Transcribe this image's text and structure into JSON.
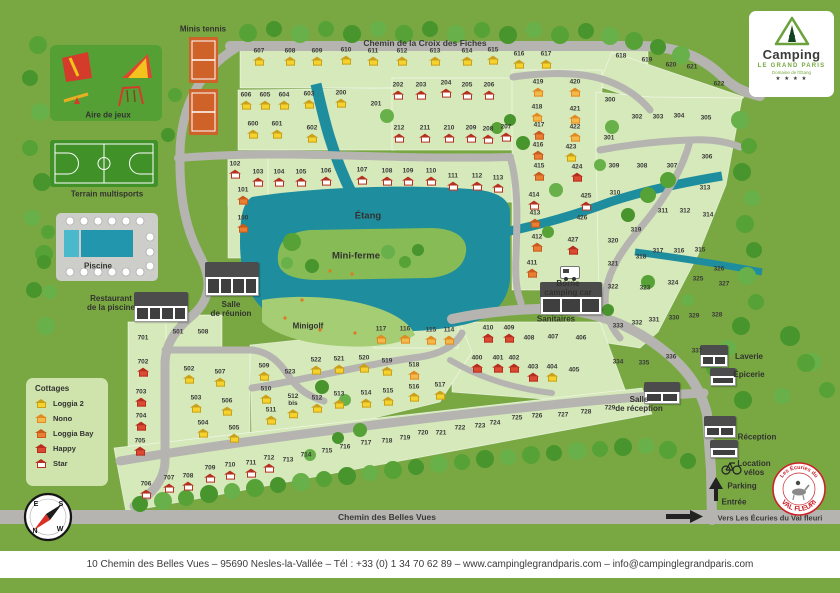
{
  "colors": {
    "background": "#79a843",
    "plot_area": "#d6e9bb",
    "road": "#b5b4b0",
    "pond": "#1e8d9e",
    "island": "#86bb55",
    "minigolf": "#a5cd74",
    "tree": [
      "#56a236",
      "#47952c",
      "#68b14a"
    ],
    "cottages": {
      "l2": {
        "roof": "#caa019",
        "body": "#f5d32c"
      },
      "no": {
        "roof": "#e08a21",
        "body": "#f4b94a"
      },
      "lb": {
        "roof": "#c85a1c",
        "body": "#ea7f33"
      },
      "ha": {
        "roof": "#b72c1c",
        "body": "#dd4a33"
      },
      "st": {
        "roof": "#b5301f",
        "body": "#ffffff"
      }
    }
  },
  "logo": {
    "brand": "Camping",
    "name": "LE GRAND PARIS",
    "tagline": "Domaine de l'Étang",
    "stars": "★ ★ ★ ★"
  },
  "valfleuri": {
    "top": "Les Écuries du",
    "bottom": "VAL FLEURI"
  },
  "footer": {
    "text": "10 Chemin des Belles Vues – 95690 Nesles-la-Vallée – Tél : +33 (0) 1 34 70 62 89 – www.campinglegrandparis.com –  info@campinglegrandparis.com"
  },
  "roads": {
    "top": "Chemin de la Croix des Fiches",
    "bottom": "Chemin des Belles Vues",
    "exit": "Vers Les Écuries du Val fleuri"
  },
  "legend": {
    "title": "Cottages",
    "items": [
      {
        "label": "Loggia 2",
        "type": "l2"
      },
      {
        "label": "Nono",
        "type": "no"
      },
      {
        "label": "Loggia Bay",
        "type": "lb"
      },
      {
        "label": "Happy",
        "type": "ha"
      },
      {
        "label": "Star",
        "type": "st"
      }
    ]
  },
  "compass": {
    "points": [
      "E",
      "S",
      "N",
      "W"
    ]
  },
  "facilities": [
    {
      "id": "minis-tennis",
      "label": "Minis tennis",
      "x": 203,
      "y": 29,
      "big": false
    },
    {
      "id": "aire-de-jeux",
      "label": "Aire de jeux",
      "x": 108,
      "y": 115,
      "big": false
    },
    {
      "id": "terrain-multisports",
      "label": "Terrain multisports",
      "x": 107,
      "y": 194,
      "big": false
    },
    {
      "id": "piscine",
      "label": "Piscine",
      "x": 98,
      "y": 266,
      "big": false
    },
    {
      "id": "restaurant-piscine",
      "label": "Restaurant\nde la piscine",
      "x": 111,
      "y": 303,
      "big": false
    },
    {
      "id": "salle-de-reunion",
      "label": "Salle\nde réunion",
      "x": 231,
      "y": 309,
      "big": false
    },
    {
      "id": "etang",
      "label": "Étang",
      "x": 368,
      "y": 217,
      "big": true
    },
    {
      "id": "mini-ferme",
      "label": "Mini-ferme",
      "x": 356,
      "y": 257,
      "big": true
    },
    {
      "id": "minigolf",
      "label": "Minigolf",
      "x": 308,
      "y": 326,
      "big": false
    },
    {
      "id": "borne-camping-car",
      "label": "Borne\ncamping car",
      "x": 568,
      "y": 288,
      "big": false
    },
    {
      "id": "sanitaires",
      "label": "Sanitaires",
      "x": 556,
      "y": 319,
      "big": false
    },
    {
      "id": "laverie-epicerie",
      "label": "Laverie\n\nÉpicerie",
      "x": 749,
      "y": 366,
      "big": false
    },
    {
      "id": "salle-de-reception",
      "label": "Salle\nde réception",
      "x": 639,
      "y": 404,
      "big": false
    },
    {
      "id": "reception",
      "label": "Réception",
      "x": 757,
      "y": 437,
      "big": false
    },
    {
      "id": "location-velos",
      "label": "Location\nvélos",
      "x": 754,
      "y": 468,
      "big": false
    },
    {
      "id": "parking",
      "label": "Parking",
      "x": 742,
      "y": 486,
      "big": false
    },
    {
      "id": "entree",
      "label": "Entrée",
      "x": 734,
      "y": 502,
      "big": false
    }
  ],
  "plots": [
    [
      "607",
      259,
      57,
      "l2"
    ],
    [
      "608",
      290,
      57,
      "l2"
    ],
    [
      "609",
      317,
      57,
      "l2"
    ],
    [
      "610",
      346,
      56,
      "l2"
    ],
    [
      "611",
      373,
      57,
      "l2"
    ],
    [
      "612",
      402,
      57,
      "l2"
    ],
    [
      "613",
      435,
      57,
      "l2"
    ],
    [
      "614",
      467,
      57,
      "l2"
    ],
    [
      "615",
      493,
      56,
      "l2"
    ],
    [
      "616",
      519,
      60,
      "l2"
    ],
    [
      "617",
      546,
      60,
      "l2"
    ],
    [
      "618",
      621,
      57,
      null
    ],
    [
      "619",
      647,
      61,
      null
    ],
    [
      "620",
      671,
      66,
      null
    ],
    [
      "621",
      692,
      68,
      null
    ],
    [
      "622",
      719,
      85,
      null
    ],
    [
      "606",
      246,
      101,
      "l2"
    ],
    [
      "605",
      265,
      101,
      "l2"
    ],
    [
      "604",
      284,
      101,
      "l2"
    ],
    [
      "603",
      309,
      100,
      "l2"
    ],
    [
      "600",
      253,
      130,
      "l2"
    ],
    [
      "601",
      277,
      130,
      "l2"
    ],
    [
      "602",
      312,
      134,
      "l2"
    ],
    [
      "200",
      341,
      99,
      "l2"
    ],
    [
      "201",
      376,
      105,
      null
    ],
    [
      "202",
      398,
      91,
      "st"
    ],
    [
      "203",
      421,
      91,
      "st"
    ],
    [
      "204",
      446,
      89,
      "st"
    ],
    [
      "205",
      467,
      91,
      "st"
    ],
    [
      "206",
      489,
      91,
      "st"
    ],
    [
      "212",
      399,
      134,
      "st"
    ],
    [
      "211",
      425,
      134,
      "st"
    ],
    [
      "210",
      449,
      134,
      "st"
    ],
    [
      "209",
      471,
      134,
      "st"
    ],
    [
      "208",
      488,
      135,
      "st"
    ],
    [
      "207",
      506,
      133,
      "st"
    ],
    [
      "102",
      235,
      170,
      "st"
    ],
    [
      "103",
      258,
      178,
      "st"
    ],
    [
      "104",
      279,
      178,
      "st"
    ],
    [
      "105",
      301,
      178,
      "st"
    ],
    [
      "106",
      326,
      177,
      "st"
    ],
    [
      "107",
      362,
      176,
      "st"
    ],
    [
      "108",
      387,
      177,
      "st"
    ],
    [
      "109",
      408,
      177,
      "st"
    ],
    [
      "110",
      431,
      177,
      "st"
    ],
    [
      "111",
      453,
      182,
      "st"
    ],
    [
      "112",
      477,
      182,
      "st"
    ],
    [
      "113",
      498,
      184,
      "st"
    ],
    [
      "101",
      243,
      196,
      "lb"
    ],
    [
      "100",
      243,
      224,
      "lb"
    ],
    [
      "419",
      538,
      88,
      "no"
    ],
    [
      "420",
      575,
      88,
      "no"
    ],
    [
      "418",
      537,
      113,
      "no"
    ],
    [
      "421",
      575,
      115,
      "no"
    ],
    [
      "417",
      539,
      131,
      "lb"
    ],
    [
      "422",
      575,
      133,
      "no"
    ],
    [
      "416",
      538,
      151,
      "lb"
    ],
    [
      "423",
      571,
      153,
      "l2"
    ],
    [
      "415",
      539,
      172,
      "lb"
    ],
    [
      "424",
      577,
      173,
      "ha"
    ],
    [
      "414",
      534,
      201,
      "st"
    ],
    [
      "425",
      586,
      202,
      "st"
    ],
    [
      "413",
      535,
      219,
      "lb"
    ],
    [
      "426",
      582,
      219,
      null
    ],
    [
      "412",
      537,
      243,
      "lb"
    ],
    [
      "427",
      573,
      246,
      "ha"
    ],
    [
      "411",
      532,
      269,
      "lb"
    ],
    [
      "300",
      610,
      101,
      null
    ],
    [
      "301",
      609,
      139,
      null
    ],
    [
      "302",
      637,
      118,
      null
    ],
    [
      "303",
      658,
      118,
      null
    ],
    [
      "304",
      679,
      117,
      null
    ],
    [
      "305",
      706,
      119,
      null
    ],
    [
      "306",
      707,
      158,
      null
    ],
    [
      "307",
      672,
      167,
      null
    ],
    [
      "308",
      642,
      167,
      null
    ],
    [
      "309",
      614,
      167,
      null
    ],
    [
      "310",
      615,
      194,
      null
    ],
    [
      "311",
      663,
      212,
      null
    ],
    [
      "312",
      685,
      212,
      null
    ],
    [
      "313",
      705,
      189,
      null
    ],
    [
      "314",
      708,
      216,
      null
    ],
    [
      "315",
      700,
      251,
      null
    ],
    [
      "316",
      679,
      252,
      null
    ],
    [
      "317",
      658,
      252,
      null
    ],
    [
      "318",
      641,
      258,
      null
    ],
    [
      "319",
      636,
      231,
      null
    ],
    [
      "320",
      613,
      242,
      null
    ],
    [
      "321",
      613,
      265,
      null
    ],
    [
      "322",
      613,
      288,
      null
    ],
    [
      "323",
      645,
      289,
      null
    ],
    [
      "324",
      673,
      284,
      null
    ],
    [
      "325",
      698,
      280,
      null
    ],
    [
      "326",
      719,
      270,
      null
    ],
    [
      "327",
      724,
      285,
      null
    ],
    [
      "328",
      717,
      316,
      null
    ],
    [
      "329",
      694,
      317,
      null
    ],
    [
      "330",
      674,
      319,
      null
    ],
    [
      "331",
      654,
      321,
      null
    ],
    [
      "332",
      637,
      324,
      null
    ],
    [
      "333",
      618,
      327,
      null
    ],
    [
      "334",
      618,
      363,
      null
    ],
    [
      "335",
      644,
      364,
      null
    ],
    [
      "336",
      671,
      358,
      null
    ],
    [
      "337",
      697,
      352,
      null
    ],
    [
      "410",
      488,
      334,
      "ha"
    ],
    [
      "409",
      509,
      334,
      "ha"
    ],
    [
      "408",
      529,
      339,
      null
    ],
    [
      "407",
      553,
      338,
      null
    ],
    [
      "406",
      581,
      339,
      null
    ],
    [
      "400",
      477,
      364,
      "ha"
    ],
    [
      "401",
      498,
      364,
      "ha"
    ],
    [
      "402",
      514,
      364,
      "ha"
    ],
    [
      "403",
      533,
      373,
      "ha"
    ],
    [
      "404",
      552,
      373,
      "l2"
    ],
    [
      "405",
      574,
      371,
      null
    ],
    [
      "501",
      178,
      333,
      null
    ],
    [
      "508",
      203,
      333,
      null
    ],
    [
      "502",
      189,
      375,
      "l2"
    ],
    [
      "507",
      220,
      378,
      "l2"
    ],
    [
      "503",
      196,
      404,
      "l2"
    ],
    [
      "506",
      227,
      407,
      "l2"
    ],
    [
      "504",
      203,
      429,
      "l2"
    ],
    [
      "505",
      234,
      434,
      "l2"
    ],
    [
      "509",
      264,
      372,
      "l2"
    ],
    [
      "510",
      266,
      395,
      "l2"
    ],
    [
      "511",
      271,
      416,
      "l2"
    ],
    [
      "512\nbis",
      293,
      406,
      "l2"
    ],
    [
      "512",
      317,
      404,
      "l2"
    ],
    [
      "513",
      339,
      400,
      "l2"
    ],
    [
      "514",
      366,
      399,
      "l2"
    ],
    [
      "515",
      388,
      397,
      "l2"
    ],
    [
      "516",
      414,
      393,
      "l2"
    ],
    [
      "517",
      440,
      391,
      "l2"
    ],
    [
      "518",
      414,
      371,
      "no"
    ],
    [
      "519",
      387,
      367,
      "l2"
    ],
    [
      "520",
      364,
      364,
      "l2"
    ],
    [
      "521",
      339,
      365,
      "l2"
    ],
    [
      "522",
      316,
      366,
      "l2"
    ],
    [
      "523",
      290,
      373,
      null
    ],
    [
      "117",
      381,
      335,
      "no"
    ],
    [
      "116",
      405,
      335,
      "no"
    ],
    [
      "115",
      431,
      336,
      "no"
    ],
    [
      "114",
      449,
      336,
      "no"
    ],
    [
      "701",
      143,
      339,
      null
    ],
    [
      "702",
      143,
      368,
      "ha"
    ],
    [
      "703",
      141,
      398,
      "ha"
    ],
    [
      "704",
      141,
      422,
      "ha"
    ],
    [
      "705",
      140,
      447,
      "ha"
    ],
    [
      "706",
      146,
      490,
      "st"
    ],
    [
      "707",
      169,
      484,
      "st"
    ],
    [
      "708",
      188,
      482,
      "st"
    ],
    [
      "709",
      210,
      474,
      "st"
    ],
    [
      "710",
      230,
      471,
      "st"
    ],
    [
      "711",
      251,
      469,
      "st"
    ],
    [
      "712",
      269,
      464,
      "st"
    ],
    [
      "713",
      288,
      461,
      null
    ],
    [
      "714",
      306,
      456,
      null
    ],
    [
      "715",
      327,
      452,
      null
    ],
    [
      "716",
      345,
      448,
      null
    ],
    [
      "717",
      366,
      444,
      null
    ],
    [
      "718",
      387,
      442,
      null
    ],
    [
      "719",
      405,
      439,
      null
    ],
    [
      "720",
      423,
      434,
      null
    ],
    [
      "721",
      441,
      434,
      null
    ],
    [
      "722",
      460,
      429,
      null
    ],
    [
      "723",
      480,
      427,
      null
    ],
    [
      "724",
      495,
      424,
      null
    ],
    [
      "725",
      517,
      419,
      null
    ],
    [
      "726",
      537,
      417,
      null
    ],
    [
      "727",
      563,
      416,
      null
    ],
    [
      "728",
      586,
      413,
      null
    ],
    [
      "729",
      610,
      409,
      null
    ]
  ]
}
